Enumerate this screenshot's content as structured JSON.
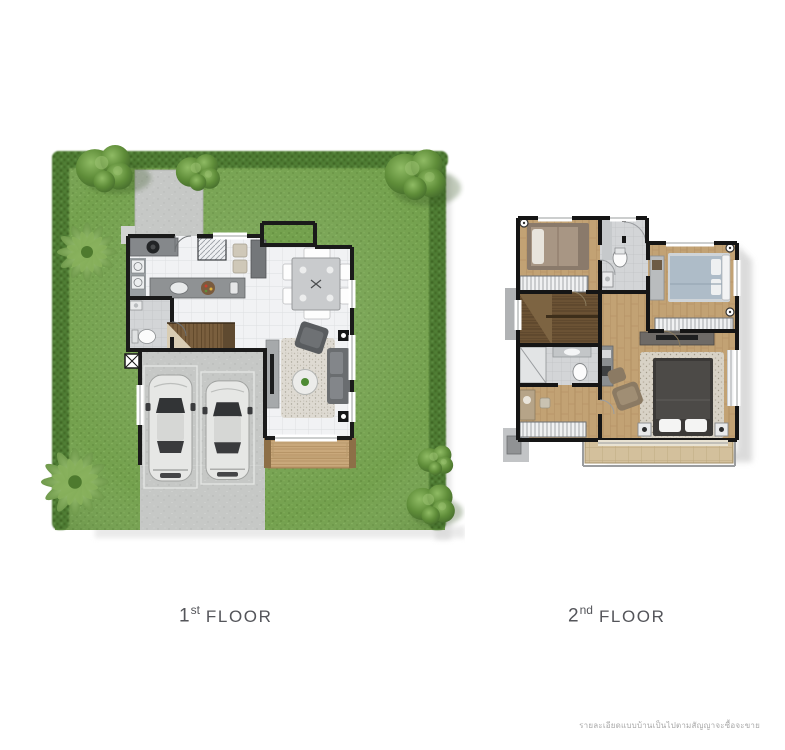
{
  "floors": [
    {
      "id": "first",
      "num": "1",
      "ordinal": "st",
      "word": "FLOOR"
    },
    {
      "id": "second",
      "num": "2",
      "ordinal": "nd",
      "word": "FLOOR"
    }
  ],
  "disclaimer": "รายละเอียดแบบบ้านเป็นไปตามสัญญาจะซื้อจะขาย",
  "colors": {
    "lawn": "#74a14e",
    "lawn-dark": "#618c3c",
    "hedge": "#4d7a31",
    "hedge-dark": "#3a611f",
    "concrete": "#c6c8c6",
    "wall": "#1a1a1a",
    "tile": "#f1f2f4",
    "tile-line": "#dcdee0",
    "bathtile": "#d3d5d7",
    "wood": "#c2a274",
    "wood-line": "#ab8a5c",
    "stair": "#7a5f3e",
    "deck": "#c9a87b",
    "balcony": "#d3c09c",
    "rug": "#dedad2",
    "sofa": "#6a6d70",
    "counter": "#8a8d90",
    "bed-blue": "#aebcc8",
    "bed-dark": "#4c4a47",
    "bed-brown": "#a89684",
    "label": "#54555a",
    "disclaimer": "#a9a9a9",
    "shadow": "#d2d2d2",
    "bg": "#ffffff"
  }
}
